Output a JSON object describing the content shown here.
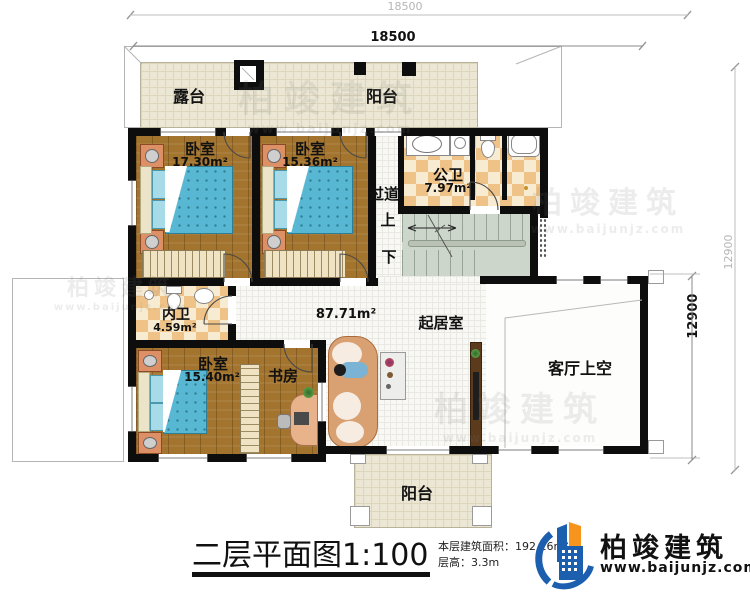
{
  "dimensions": {
    "top_outer": "18500",
    "top_inner": "18500",
    "right_outer": "12900",
    "right_inner": "12900"
  },
  "rooms": {
    "terrace": {
      "label": "露台"
    },
    "balcony_top": {
      "label": "阳台"
    },
    "bedroom1": {
      "label": "卧室",
      "area": "17.30m²"
    },
    "bedroom2": {
      "label": "卧室",
      "area": "15.36m²"
    },
    "public_bath": {
      "label": "公卫",
      "area": "7.97m²"
    },
    "corridor": {
      "label": "过道"
    },
    "stairs": {
      "up": "上",
      "down": "下"
    },
    "inner_bath": {
      "label": "内卫",
      "area": "4.59m²"
    },
    "bedroom3": {
      "label": "卧室",
      "area": "15.40m²"
    },
    "study": {
      "label": "书房"
    },
    "living_room": {
      "label": "起居室",
      "area": "87.71m²"
    },
    "void": {
      "label": "客厅上空"
    },
    "balcony_bottom": {
      "label": "阳台"
    }
  },
  "title": {
    "text": "二层平面图1:100"
  },
  "info": {
    "floor_area": "本层建筑面积：192.16m²",
    "floor_height": "层高：3.3m"
  },
  "logo": {
    "name": "柏竣建筑",
    "url": "www.baijunjz.com"
  },
  "watermark": {
    "brand": "柏竣建筑",
    "url": "www.baijunjz.com"
  }
}
